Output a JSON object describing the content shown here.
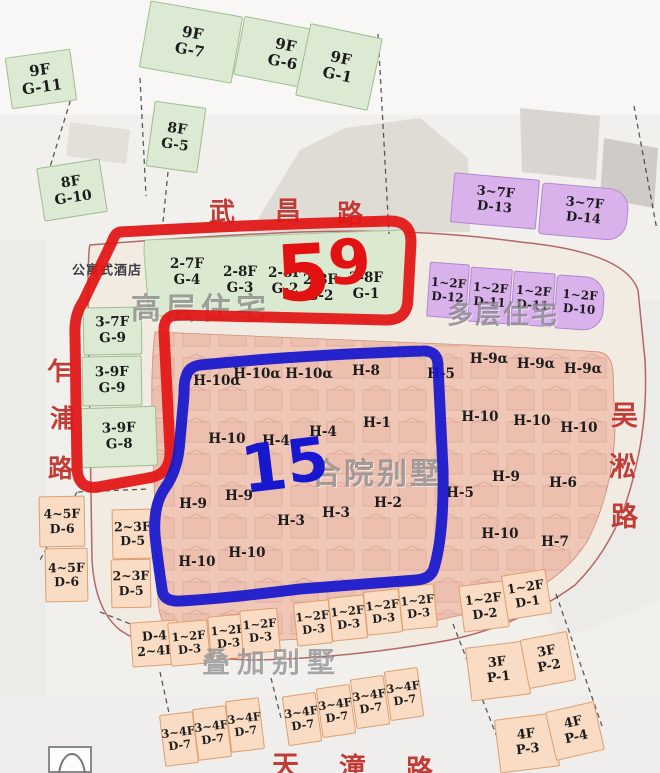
{
  "annotations": {
    "red_count": "59",
    "blue_count": "15",
    "red_color": "#e31212",
    "blue_color": "#1717cf"
  },
  "colors": {
    "green_block": "#dcead3",
    "purple_block": "#d9b2ec",
    "peach_block": "#f9dcc3",
    "pink_zone": "#f0c6b6",
    "road_text_red": "#c23b35"
  },
  "roads": {
    "wuchang": {
      "name": "武昌路",
      "size": 26,
      "chars": [
        {
          "c": "武",
          "x": 209,
          "y": 192
        },
        {
          "c": "昌",
          "x": 275,
          "y": 191
        },
        {
          "c": "路",
          "x": 337,
          "y": 194
        }
      ]
    },
    "zhapu": {
      "name": "乍浦路",
      "size": 25,
      "chars": [
        {
          "c": "乍",
          "x": 47,
          "y": 352
        },
        {
          "c": "浦",
          "x": 50,
          "y": 399
        },
        {
          "c": "路",
          "x": 48,
          "y": 449
        }
      ]
    },
    "wusong": {
      "name": "吴淞路",
      "size": 27,
      "chars": [
        {
          "c": "吴",
          "x": 611,
          "y": 394
        },
        {
          "c": "淞",
          "x": 609,
          "y": 445
        },
        {
          "c": "路",
          "x": 611,
          "y": 495
        }
      ]
    },
    "tiantong": {
      "name": "天潼路",
      "size": 27,
      "chars": [
        {
          "c": "天",
          "x": 272,
          "y": 744
        },
        {
          "c": "潼",
          "x": 339,
          "y": 746
        },
        {
          "c": "路",
          "x": 406,
          "y": 748
        }
      ]
    }
  },
  "zone_labels": [
    {
      "text": "公寓式酒店",
      "x": 107,
      "y": 269,
      "size": 13,
      "ls": 1,
      "color": "#3a3a3f"
    },
    {
      "text": "高层住宅",
      "x": 201,
      "y": 306,
      "size": 30,
      "ls": 5,
      "color": "rgba(125,128,120,0.72)"
    },
    {
      "text": "多层住宅",
      "x": 503,
      "y": 313,
      "size": 26,
      "ls": 2,
      "color": "rgba(122,118,128,0.7)"
    },
    {
      "text": "合院别墅",
      "x": 377,
      "y": 471,
      "size": 30,
      "ls": 3,
      "color": "rgba(122,122,124,0.68)"
    },
    {
      "text": "叠加别墅",
      "x": 272,
      "y": 661,
      "size": 28,
      "ls": 7,
      "color": "rgba(118,118,120,0.62)"
    }
  ],
  "blocks": [
    {
      "floors": "9F",
      "code": "G-11",
      "type": "green",
      "x": 8,
      "y": 53,
      "w": 66,
      "h": 52,
      "rot": -8,
      "fs": 15
    },
    {
      "floors": "9F",
      "code": "G-7",
      "type": "green",
      "x": 144,
      "y": 8,
      "w": 94,
      "h": 68,
      "rot": 10,
      "fs": 15
    },
    {
      "floors": "9F",
      "code": "G-6",
      "type": "green",
      "x": 238,
      "y": 24,
      "w": 92,
      "h": 60,
      "rot": 11,
      "fs": 15
    },
    {
      "floors": "9F",
      "code": "G-1",
      "type": "green",
      "x": 302,
      "y": 30,
      "w": 74,
      "h": 74,
      "rot": 12,
      "fs": 15
    },
    {
      "floors": "8F",
      "code": "G-5",
      "type": "green",
      "x": 150,
      "y": 104,
      "w": 52,
      "h": 66,
      "rot": 8,
      "fs": 14
    },
    {
      "floors": "8F",
      "code": "G-10",
      "type": "green",
      "x": 40,
      "y": 163,
      "w": 64,
      "h": 54,
      "rot": -9,
      "fs": 14
    },
    {
      "floors": "3-7F",
      "code": "G-9",
      "type": "green",
      "x": 83,
      "y": 307,
      "w": 59,
      "h": 48,
      "rot": -1,
      "fs": 13.5
    },
    {
      "floors": "3-9F",
      "code": "G-9",
      "type": "green",
      "x": 82,
      "y": 356,
      "w": 60,
      "h": 50,
      "rot": -1,
      "fs": 13.5
    },
    {
      "floors": "3-9F",
      "code": "G-8",
      "type": "green",
      "x": 81,
      "y": 407,
      "w": 76,
      "h": 60,
      "rot": -2,
      "fs": 13.5
    },
    {
      "floors": "3~7F",
      "code": "D-13",
      "type": "purple",
      "x": 452,
      "y": 176,
      "w": 86,
      "h": 50,
      "rot": 5,
      "fs": 13
    },
    {
      "floors": "3~7F",
      "code": "D-14",
      "type": "purple",
      "x": 540,
      "y": 186,
      "w": 88,
      "h": 52,
      "rot": 5,
      "fs": 13,
      "round": true
    },
    {
      "floors": "1~2F",
      "code": "D-12",
      "type": "purple",
      "x": 428,
      "y": 263,
      "w": 40,
      "h": 55,
      "rot": 4,
      "fs": 12
    },
    {
      "floors": "1~2F",
      "code": "D-11",
      "type": "purple",
      "x": 469,
      "y": 268,
      "w": 42,
      "h": 55,
      "rot": 4,
      "fs": 12
    },
    {
      "floors": "1~2F",
      "code": "D-11",
      "type": "purple",
      "x": 512,
      "y": 272,
      "w": 42,
      "h": 54,
      "rot": 4,
      "fs": 12
    },
    {
      "floors": "1~2F",
      "code": "D-10",
      "type": "purple",
      "x": 555,
      "y": 276,
      "w": 49,
      "h": 54,
      "rot": 4,
      "fs": 12,
      "round": true
    },
    {
      "floors": "4~5F",
      "code": "D-6",
      "type": "peach",
      "x": 39,
      "y": 496,
      "w": 46,
      "h": 51,
      "rot": -1,
      "fs": 12.5
    },
    {
      "floors": "4~5F",
      "code": "D-6",
      "type": "peach",
      "x": 45,
      "y": 548,
      "w": 43,
      "h": 54,
      "rot": -1,
      "fs": 12.5
    },
    {
      "floors": "2~3F",
      "code": "D-5",
      "type": "peach",
      "x": 112,
      "y": 509,
      "w": 41,
      "h": 50,
      "rot": -1,
      "fs": 12.5
    },
    {
      "floors": "2~3F",
      "code": "D-5",
      "type": "peach",
      "x": 111,
      "y": 559,
      "w": 40,
      "h": 49,
      "rot": -1,
      "fs": 12.5
    },
    {
      "floors": "D-4",
      "code": "2~4F",
      "type": "peach",
      "x": 131,
      "y": 621,
      "w": 48,
      "h": 45,
      "rot": -4,
      "fs": 12.5
    },
    {
      "floors": "1~2F",
      "code": "D-3",
      "type": "peach",
      "x": 169,
      "y": 621,
      "w": 40,
      "h": 44,
      "rot": -5,
      "fs": 11.5
    },
    {
      "floors": "1~2F",
      "code": "D-3",
      "type": "peach",
      "x": 209,
      "y": 615,
      "w": 38,
      "h": 44,
      "rot": -5,
      "fs": 11.5
    },
    {
      "floors": "1~2F",
      "code": "D-3",
      "type": "peach",
      "x": 241,
      "y": 609,
      "w": 38,
      "h": 44,
      "rot": -5,
      "fs": 11.5
    },
    {
      "floors": "1~2F",
      "code": "D-3",
      "type": "peach",
      "x": 295,
      "y": 601,
      "w": 36,
      "h": 44,
      "rot": -6,
      "fs": 11.5
    },
    {
      "floors": "1~2F",
      "code": "D-3",
      "type": "peach",
      "x": 330,
      "y": 596,
      "w": 36,
      "h": 44,
      "rot": -6,
      "fs": 11.5
    },
    {
      "floors": "1~2F",
      "code": "D-3",
      "type": "peach",
      "x": 365,
      "y": 590,
      "w": 36,
      "h": 44,
      "rot": -6,
      "fs": 11.5
    },
    {
      "floors": "1~2F",
      "code": "D-3",
      "type": "peach",
      "x": 400,
      "y": 585,
      "w": 36,
      "h": 44,
      "rot": -6,
      "fs": 11.5
    },
    {
      "floors": "1~2F",
      "code": "D-2",
      "type": "peach",
      "x": 461,
      "y": 583,
      "w": 46,
      "h": 47,
      "rot": -7,
      "fs": 12.5
    },
    {
      "floors": "1~2F",
      "code": "D-1",
      "type": "peach",
      "x": 504,
      "y": 572,
      "w": 45,
      "h": 45,
      "rot": -9,
      "fs": 12.5
    },
    {
      "floors": "3F",
      "code": "P-1",
      "type": "peach",
      "x": 468,
      "y": 644,
      "w": 60,
      "h": 54,
      "rot": -7,
      "fs": 13
    },
    {
      "floors": "3F",
      "code": "P-2",
      "type": "peach",
      "x": 524,
      "y": 635,
      "w": 48,
      "h": 50,
      "rot": -11,
      "fs": 13
    },
    {
      "floors": "4F",
      "code": "P-3",
      "type": "peach",
      "x": 497,
      "y": 716,
      "w": 60,
      "h": 54,
      "rot": -7,
      "fs": 13
    },
    {
      "floors": "4F",
      "code": "P-4",
      "type": "peach",
      "x": 550,
      "y": 706,
      "w": 50,
      "h": 50,
      "rot": -13,
      "fs": 13
    },
    {
      "floors": "3~4F",
      "code": "D-7",
      "type": "peach",
      "x": 162,
      "y": 713,
      "w": 34,
      "h": 52,
      "rot": -7,
      "fs": 11.5
    },
    {
      "floors": "3~4F",
      "code": "D-7",
      "type": "peach",
      "x": 195,
      "y": 707,
      "w": 34,
      "h": 52,
      "rot": -7,
      "fs": 11.5
    },
    {
      "floors": "3~4F",
      "code": "D-7",
      "type": "peach",
      "x": 228,
      "y": 699,
      "w": 34,
      "h": 52,
      "rot": -7,
      "fs": 11.5
    },
    {
      "floors": "3~4F",
      "code": "D-7",
      "type": "peach",
      "x": 285,
      "y": 694,
      "w": 34,
      "h": 50,
      "rot": -8,
      "fs": 11.5
    },
    {
      "floors": "3~4F",
      "code": "D-7",
      "type": "peach",
      "x": 319,
      "y": 686,
      "w": 34,
      "h": 50,
      "rot": -8,
      "fs": 11.5
    },
    {
      "floors": "3~4F",
      "code": "D-7",
      "type": "peach",
      "x": 353,
      "y": 677,
      "w": 34,
      "h": 50,
      "rot": -8,
      "fs": 11.5
    },
    {
      "floors": "3~4F",
      "code": "D-7",
      "type": "peach",
      "x": 387,
      "y": 669,
      "w": 34,
      "h": 50,
      "rot": -8,
      "fs": 11.5
    }
  ],
  "tower_labels": [
    {
      "floors": "2-7F",
      "code": "G-4",
      "x": 187,
      "y": 272
    },
    {
      "floors": "2-8F",
      "code": "G-3",
      "x": 240,
      "y": 280
    },
    {
      "floors": "2-8F",
      "code": "G-2",
      "x": 285,
      "y": 281
    },
    {
      "floors": "2-8F",
      "code": "G-2",
      "x": 320,
      "y": 288
    },
    {
      "floors": "2-8F",
      "code": "G-1",
      "x": 366,
      "y": 286
    }
  ],
  "unit_labels": [
    {
      "text": "H-10α",
      "x": 217,
      "y": 381
    },
    {
      "text": "H-10α",
      "x": 257,
      "y": 374
    },
    {
      "text": "H-10α",
      "x": 309,
      "y": 374
    },
    {
      "text": "H-8",
      "x": 366,
      "y": 371
    },
    {
      "text": "H-5",
      "x": 441,
      "y": 374
    },
    {
      "text": "H-9α",
      "x": 489,
      "y": 359
    },
    {
      "text": "H-9α",
      "x": 536,
      "y": 364
    },
    {
      "text": "H-9α",
      "x": 583,
      "y": 369
    },
    {
      "text": "H-10",
      "x": 227,
      "y": 439
    },
    {
      "text": "H-4",
      "x": 276,
      "y": 441
    },
    {
      "text": "H-4",
      "x": 323,
      "y": 432
    },
    {
      "text": "H-1",
      "x": 377,
      "y": 423
    },
    {
      "text": "H-10",
      "x": 480,
      "y": 417
    },
    {
      "text": "H-10",
      "x": 532,
      "y": 421
    },
    {
      "text": "H-10",
      "x": 579,
      "y": 428
    },
    {
      "text": "H-9",
      "x": 193,
      "y": 504
    },
    {
      "text": "H-9",
      "x": 239,
      "y": 496
    },
    {
      "text": "H-3",
      "x": 291,
      "y": 521
    },
    {
      "text": "H-3",
      "x": 336,
      "y": 513
    },
    {
      "text": "H-2",
      "x": 388,
      "y": 503
    },
    {
      "text": "H-5",
      "x": 460,
      "y": 493
    },
    {
      "text": "H-9",
      "x": 506,
      "y": 477
    },
    {
      "text": "H-6",
      "x": 563,
      "y": 483
    },
    {
      "text": "H-10",
      "x": 197,
      "y": 562
    },
    {
      "text": "H-10",
      "x": 247,
      "y": 553
    },
    {
      "text": "H-10",
      "x": 500,
      "y": 534
    },
    {
      "text": "H-7",
      "x": 555,
      "y": 542
    }
  ]
}
